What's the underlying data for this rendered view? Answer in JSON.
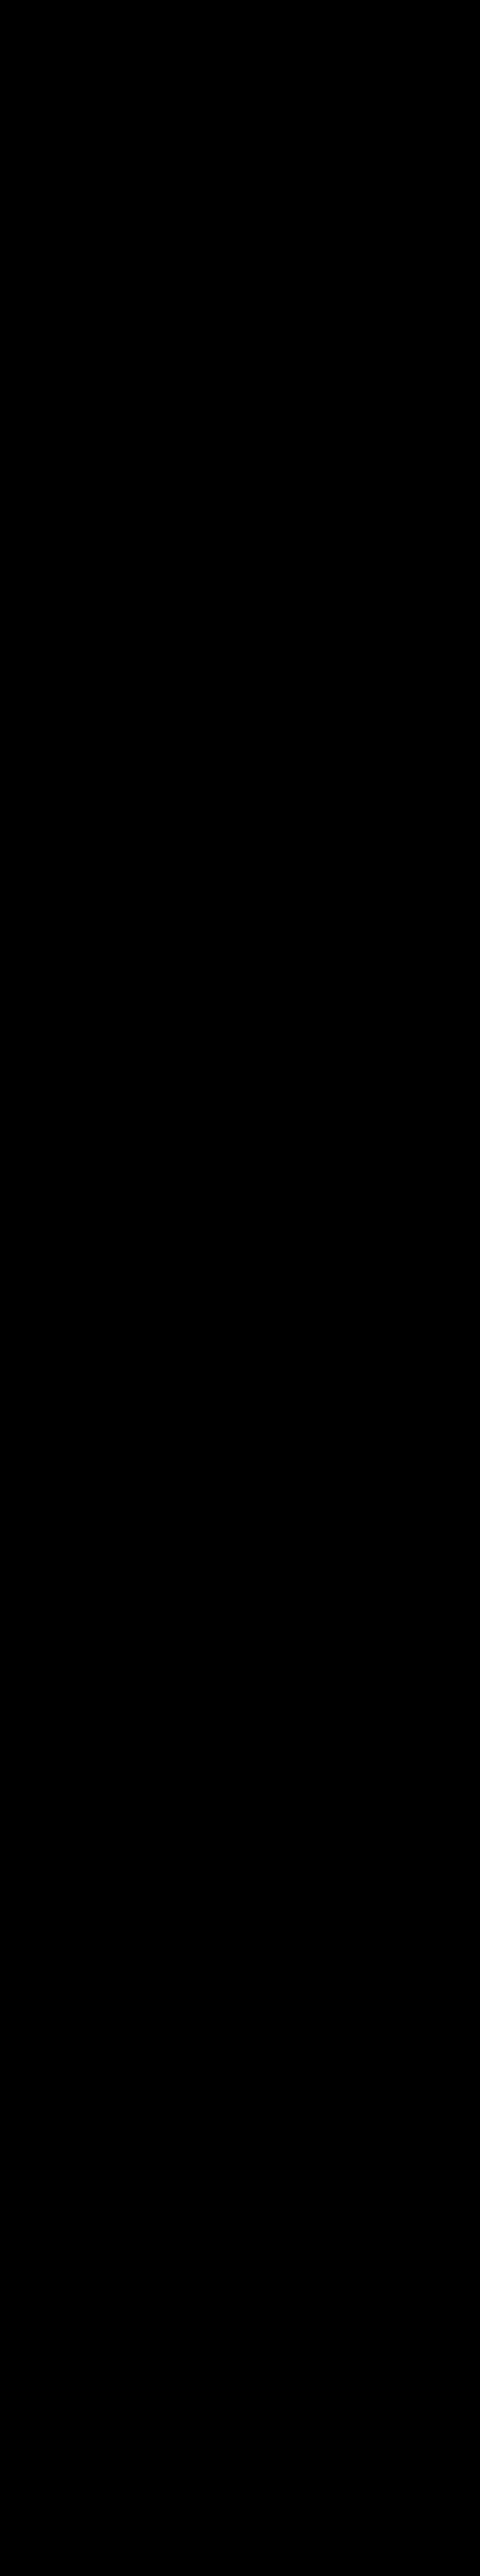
{
  "watermark": "BRACELETBOOK.COM",
  "colors": {
    "background": "#000000",
    "navy": "#1B3B7D",
    "orange": "#FFA41C",
    "red": "#E81112",
    "string_white": "#FFFFFF",
    "label_gray": "#9A9A9A",
    "watermark_gray": "#4D4D4D"
  },
  "grid": {
    "columns": 15,
    "rows": 91,
    "palette": {
      "B": "navy",
      "O": "orange",
      "R": "red"
    },
    "arrow_right": "→",
    "arrow_left": "←",
    "row_data": [
      {
        "n": 1,
        "dir": "right",
        "knots": "BOBBOOBOBOOBBOB"
      },
      {
        "n": 2,
        "dir": "left",
        "knots": "OOBOOBOOOBOOBOO"
      },
      {
        "n": 3,
        "dir": "right",
        "knots": "BBOOBOOOOOBBOBB"
      },
      {
        "n": 4,
        "dir": "left",
        "knots": "BOOBOOBBBOOBOOB"
      },
      {
        "n": 5,
        "dir": "right",
        "knots": "OOBOOOOOBOOOOOO"
      },
      {
        "n": 6,
        "dir": "left",
        "knots": "OBOBOOOOOBBOOBO"
      },
      {
        "n": 7,
        "dir": "right",
        "knots": "BOOBBOBOBBOBOOB"
      },
      {
        "n": 8,
        "dir": "left",
        "knots": "OOBBOOOBBBBBBOO"
      },
      {
        "n": 9,
        "dir": "right",
        "knots": "OBBOBOBBBBBBBOO"
      },
      {
        "n": 10,
        "dir": "left",
        "knots": "BBOOOBBBRRRRRRB"
      },
      {
        "n": 11,
        "dir": "right",
        "knots": "BBBOBBBBRRRRRRB"
      },
      {
        "n": 12,
        "dir": "left",
        "knots": "BBBBBBBBRBBBBRB"
      },
      {
        "n": 13,
        "dir": "right",
        "knots": "BBBBBBBBRBBBBRB"
      },
      {
        "n": 14,
        "dir": "left",
        "knots": "BBBRRRRBBRRRRBB"
      },
      {
        "n": 15,
        "dir": "right",
        "knots": "BBRRRRRBBBRRBBB"
      },
      {
        "n": 16,
        "dir": "left",
        "knots": "BRRBBBBBBBBBBBB"
      },
      {
        "n": 17,
        "dir": "right",
        "knots": "BRRBBBBBBRRRRRB"
      },
      {
        "n": 18,
        "dir": "left",
        "knots": "BBRRRRRBRRRRRRB"
      },
      {
        "n": 19,
        "dir": "right",
        "knots": "BBBRRRRBRRBBBBB"
      },
      {
        "n": 20,
        "dir": "left",
        "knots": "BBBBBBBBRRRRRRB"
      },
      {
        "n": 21,
        "dir": "right",
        "knots": "BRRRRRRBBRRRRRB"
      },
      {
        "n": 22,
        "dir": "left",
        "knots": "BRRRRRRBBBBBBBB"
      },
      {
        "n": 23,
        "dir": "right",
        "knots": "BRBRBBRBRRRRRRB"
      },
      {
        "n": 24,
        "dir": "left",
        "knots": "BRBRBBRBRRRRRRB"
      },
      {
        "n": 25,
        "dir": "right",
        "knots": "BBBBBBBBRBBBBRB"
      },
      {
        "n": 26,
        "dir": "left",
        "knots": "BRRRRRRBRBBBBRB"
      },
      {
        "n": 27,
        "dir": "right",
        "knots": "BRRRRRRBBRRRRBB"
      },
      {
        "n": 28,
        "dir": "left",
        "knots": "BBBRBBRBBBRRBBB"
      },
      {
        "n": 29,
        "dir": "right",
        "knots": "BBRRBRRBBBBBBBB"
      },
      {
        "n": 30,
        "dir": "left",
        "knots": "BRRRRRRBBRRRRRB"
      },
      {
        "n": 31,
        "dir": "right",
        "knots": "BRRBRRBBRRRRRRB"
      },
      {
        "n": 32,
        "dir": "left",
        "knots": "BBBBBBBBRRBBBBB"
      },
      {
        "n": 33,
        "dir": "right",
        "knots": "BRBRRRBBRRRRRRB"
      },
      {
        "n": 34,
        "dir": "left",
        "knots": "BRBRRRRBRRBRRRB"
      },
      {
        "n": 35,
        "dir": "right",
        "knots": "BRBRBBRBBBBBBBB"
      },
      {
        "n": 36,
        "dir": "left",
        "knots": "BRRRBRRBBBBBRRB"
      },
      {
        "n": 37,
        "dir": "right",
        "knots": "BBRRBRRBBBBBBRB"
      },
      {
        "n": 38,
        "dir": "left",
        "knots": "BBBBBBBBRRRRRRB"
      },
      {
        "n": 39,
        "dir": "right",
        "knots": "BBBBBRRBRRRRRRB"
      },
      {
        "n": 40,
        "dir": "left",
        "knots": "BBBBBRRBBBBBRRB"
      },
      {
        "n": 41,
        "dir": "right",
        "knots": "BRRRRRRBBBBBRRB"
      },
      {
        "n": 42,
        "dir": "left",
        "knots": "BRRRRRRBBBBBBBB"
      },
      {
        "n": 43,
        "dir": "right",
        "knots": "BBBBBRRBBRRRRRB"
      },
      {
        "n": 44,
        "dir": "left",
        "knots": "BBBBBRRBRRBRRRB"
      },
      {
        "n": 45,
        "dir": "right",
        "knots": "BBBBBBBBRRBBBBB"
      },
      {
        "n": 46,
        "dir": "left",
        "knots": "BRRRRBBBRBBBRRB"
      },
      {
        "n": 47,
        "dir": "right",
        "knots": "BRRRRRBBBRRRRRB"
      },
      {
        "n": 48,
        "dir": "left",
        "knots": "BBBRBRRBBBBBBRB"
      },
      {
        "n": 49,
        "dir": "right",
        "knots": "BBBRBRRBBBBBRRB"
      },
      {
        "n": 50,
        "dir": "left",
        "knots": "BRRRRRBBBBBBRRB"
      },
      {
        "n": 51,
        "dir": "right",
        "knots": "BRRRRBBBRRRRRRB"
      },
      {
        "n": 52,
        "dir": "left",
        "knots": "BBBBBBBBRRRRRRB"
      },
      {
        "n": 53,
        "dir": "right",
        "knots": "BRRRRRRBBBBBRRB"
      },
      {
        "n": 54,
        "dir": "left",
        "knots": "BRRRRRRBBBBBRRB"
      },
      {
        "n": 55,
        "dir": "right",
        "knots": "BBBRBBRBBBBBBBB"
      },
      {
        "n": 56,
        "dir": "left",
        "knots": "BBBRBBRBBRRRRRB"
      },
      {
        "n": 57,
        "dir": "right",
        "knots": "BBBRRRRBRRRRRRB"
      },
      {
        "n": 58,
        "dir": "left",
        "knots": "BBBBRRBBRRBBBBB"
      },
      {
        "n": 59,
        "dir": "right",
        "knots": "BBBBBBBBRRRRRRB"
      },
      {
        "n": 60,
        "dir": "left",
        "knots": "BRRRRRRBBRRRRRB"
      },
      {
        "n": 61,
        "dir": "right",
        "knots": "BRRRRRRBBBBBBBB"
      },
      {
        "n": 62,
        "dir": "left",
        "knots": "BBBRBBRBRRRRRRB"
      },
      {
        "n": 63,
        "dir": "right",
        "knots": "BBBRBBRBRRRRRRB"
      },
      {
        "n": 64,
        "dir": "left",
        "knots": "BBBRRRRBBBBRRBB"
      },
      {
        "n": 65,
        "dir": "right",
        "knots": "BBBBRRBBBBRRBBB"
      },
      {
        "n": 66,
        "dir": "left",
        "knots": "BBBBBBBBBBBRRBB"
      },
      {
        "n": 67,
        "dir": "right",
        "knots": "BRRRRRRBRRRRBRB"
      },
      {
        "n": 68,
        "dir": "left",
        "knots": "BRRRRRRBRRRRRRB"
      },
      {
        "n": 69,
        "dir": "right",
        "knots": "BRBRBBRBBBBBBBB"
      },
      {
        "n": 70,
        "dir": "left",
        "knots": "BRBRBBRBRRRRBBB"
      },
      {
        "n": 71,
        "dir": "right",
        "knots": "BBBBBBBBRRRRRBB"
      },
      {
        "n": 72,
        "dir": "left",
        "knots": "BRRRRRRBBBBBRRB"
      },
      {
        "n": 73,
        "dir": "right",
        "knots": "BRRRRRRBBBRBRRB"
      },
      {
        "n": 74,
        "dir": "left",
        "knots": "BBBRRRRBRRRRRBB"
      },
      {
        "n": 75,
        "dir": "right",
        "knots": "BBRRRBBBRRRRBBB"
      },
      {
        "n": 76,
        "dir": "left",
        "knots": "BRRRBBBBBBBBBBB"
      },
      {
        "n": 77,
        "dir": "right",
        "knots": "BRRRRRRBRRBBRRB"
      },
      {
        "n": 78,
        "dir": "left",
        "knots": "BRRRRRRBRRBRRRB"
      },
      {
        "n": 79,
        "dir": "right",
        "knots": "BBBBBBBBBBRRRBB"
      },
      {
        "n": 80,
        "dir": "left",
        "knots": "BBBBBBBBRRRBBBB"
      },
      {
        "n": 81,
        "dir": "right",
        "knots": "BBBOBBBBRRRBRRB"
      },
      {
        "n": 82,
        "dir": "left",
        "knots": "BBOBOBBBRRBBRRB"
      },
      {
        "n": 83,
        "dir": "right",
        "knots": "OBBOBOBBBBBBBBO"
      },
      {
        "n": 84,
        "dir": "left",
        "knots": "OOBBOOOBBBBBBOO"
      },
      {
        "n": 85,
        "dir": "right",
        "knots": "BBOBBOBOBBBBOBB"
      },
      {
        "n": 86,
        "dir": "left",
        "knots": "OBOOOBOOOBOOOBO"
      },
      {
        "n": 87,
        "dir": "right",
        "knots": "OOBOOBBOBOOOBOO"
      },
      {
        "n": 88,
        "dir": "left",
        "knots": "BOOBOOBOBOOBOOB"
      },
      {
        "n": 89,
        "dir": "right",
        "knots": "BBOOBOOOOOBOBOB"
      },
      {
        "n": 90,
        "dir": "left",
        "knots": "OOBOOBOOOBOOBOO"
      },
      {
        "n": 91,
        "dir": "right",
        "knots": "BOBBOOBOBOOBBOB"
      }
    ]
  },
  "markers": [
    {
      "row": 1,
      "side": "left",
      "label": "A",
      "color": "navy",
      "letter_color": "#FFFFFF",
      "letter_on_dash": true
    },
    {
      "row": 10,
      "side": "right",
      "label": "B",
      "color": "red",
      "letter_color": "#E81112",
      "letter_on_dash": false
    },
    {
      "row": 82,
      "side": "left",
      "label": "B",
      "color": "red",
      "letter_color": "#5a0000",
      "letter_on_dash": true
    },
    {
      "row": 91,
      "side": "right",
      "label": "A",
      "color": "navy",
      "letter_color": "#1B3B7D",
      "letter_on_dash": false
    }
  ],
  "carried_thread_marks": {
    "column": 4,
    "from_row": 11,
    "to_row": 81,
    "color": "orange"
  },
  "diagonals": [
    [
      1,
      15,
      2,
      13,
      "navy"
    ],
    [
      1,
      14,
      2,
      15,
      "orange"
    ],
    [
      3,
      1,
      2,
      3,
      "navy"
    ],
    [
      2,
      1,
      3,
      3,
      "orange"
    ],
    [
      3,
      13,
      4,
      14,
      "orange"
    ],
    [
      5,
      1,
      4,
      3,
      "navy"
    ],
    [
      4,
      1,
      5,
      3,
      "orange"
    ],
    [
      5,
      13,
      6,
      15,
      "navy"
    ],
    [
      6,
      1,
      7,
      3,
      "orange"
    ],
    [
      7,
      15,
      8,
      13,
      "navy"
    ],
    [
      7,
      13,
      8,
      15,
      "orange"
    ],
    [
      8,
      1,
      9,
      3,
      "navy"
    ],
    [
      10,
      6,
      9,
      13,
      "orange"
    ],
    [
      9,
      14,
      10,
      15,
      "navy"
    ],
    [
      10,
      3,
      11,
      4,
      "orange"
    ],
    [
      14,
      13,
      13,
      14,
      "red"
    ],
    [
      14,
      4,
      15,
      3,
      "red"
    ],
    [
      16,
      3,
      15,
      11,
      "red"
    ],
    [
      18,
      3,
      19,
      4,
      "red"
    ],
    [
      19,
      10,
      20,
      13,
      "red"
    ],
    [
      21,
      2,
      20,
      8,
      "red"
    ],
    [
      21,
      14,
      22,
      8,
      "red"
    ],
    [
      24,
      3,
      25,
      9,
      "red"
    ],
    [
      27,
      13,
      28,
      11,
      "red"
    ],
    [
      28,
      4,
      29,
      3,
      "red"
    ],
    [
      29,
      10,
      30,
      14,
      "red"
    ],
    [
      31,
      14,
      32,
      9,
      "red"
    ],
    [
      33,
      2,
      32,
      8,
      "red"
    ],
    [
      35,
      7,
      36,
      13,
      "red"
    ],
    [
      36,
      2,
      37,
      3,
      "red"
    ],
    [
      38,
      9,
      39,
      6,
      "red"
    ],
    [
      40,
      6,
      41,
      3,
      "red"
    ],
    [
      41,
      14,
      42,
      9,
      "red"
    ],
    [
      42,
      2,
      43,
      6,
      "red"
    ],
    [
      44,
      6,
      45,
      9,
      "red"
    ],
    [
      45,
      10,
      46,
      14,
      "red"
    ],
    [
      48,
      10,
      47,
      13,
      "red"
    ],
    [
      53,
      2,
      52,
      8,
      "red"
    ],
    [
      54,
      2,
      55,
      4,
      "red"
    ],
    [
      55,
      7,
      56,
      12,
      "red"
    ],
    [
      57,
      14,
      58,
      10,
      "red"
    ],
    [
      58,
      5,
      59,
      9,
      "red"
    ],
    [
      61,
      7,
      62,
      12,
      "red"
    ],
    [
      64,
      13,
      63,
      14,
      "red"
    ],
    [
      64,
      4,
      65,
      5,
      "red"
    ],
    [
      65,
      12,
      66,
      13,
      "red"
    ],
    [
      67,
      3,
      66,
      11,
      "red"
    ],
    [
      70,
      2,
      71,
      6,
      "red"
    ],
    [
      69,
      7,
      70,
      10,
      "red"
    ],
    [
      71,
      13,
      72,
      14,
      "red"
    ],
    [
      74,
      13,
      73,
      14,
      "red"
    ],
    [
      74,
      4,
      75,
      3,
      "red"
    ],
    [
      76,
      4,
      75,
      11,
      "red"
    ],
    [
      78,
      3,
      79,
      11,
      "red"
    ],
    [
      80,
      11,
      79,
      13,
      "red"
    ],
    [
      81,
      9,
      80,
      10,
      "red"
    ],
    [
      81,
      4,
      82,
      5,
      "orange"
    ],
    [
      82,
      3,
      83,
      1,
      "orange"
    ],
    [
      82,
      1,
      83,
      2,
      "navy"
    ],
    [
      83,
      13,
      84,
      15,
      "navy"
    ],
    [
      84,
      2,
      85,
      1,
      "orange"
    ],
    [
      84,
      1,
      85,
      3,
      "navy"
    ],
    [
      85,
      14,
      86,
      15,
      "navy"
    ],
    [
      86,
      2,
      87,
      3,
      "navy"
    ],
    [
      87,
      13,
      88,
      15,
      "navy"
    ],
    [
      88,
      2,
      89,
      3,
      "orange"
    ],
    [
      89,
      13,
      90,
      14,
      "orange"
    ],
    [
      89,
      15,
      90,
      13,
      "navy"
    ],
    [
      90,
      1,
      91,
      2,
      "orange"
    ],
    [
      91,
      1,
      90,
      3,
      "navy"
    ]
  ]
}
